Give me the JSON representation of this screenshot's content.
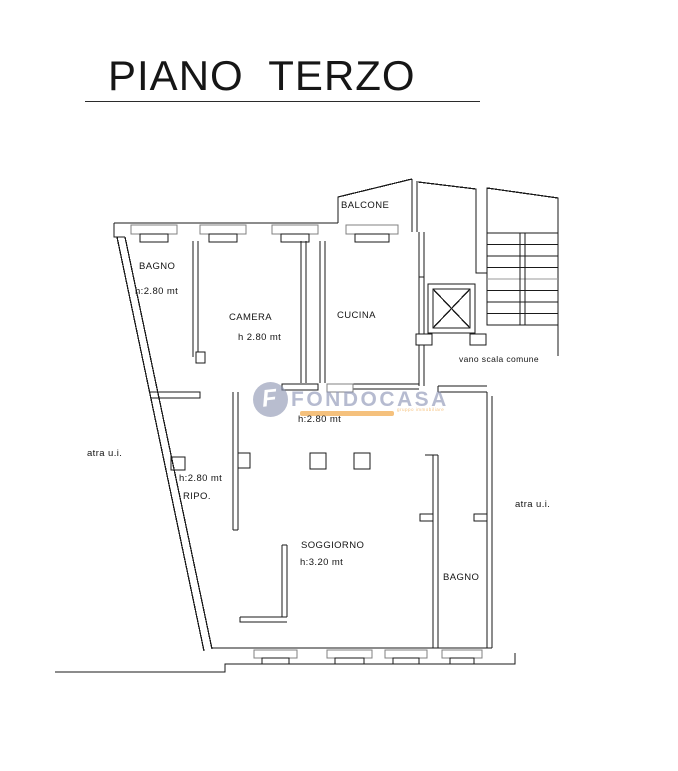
{
  "title": {
    "text": "PIANO  TERZO"
  },
  "plan": {
    "labels": {
      "bagno_nw": "BAGNO",
      "bagno_nw_h": "h:2.80 mt",
      "camera": "CAMERA",
      "camera_h": "h 2.80 mt",
      "cucina": "CUCINA",
      "balcone": "BALCONE",
      "vano_scala": "vano scala comune",
      "hall_h": "h:2.80 mt",
      "atra_ui_left": "atra u.i.",
      "ripo_h": "h:2.80 mt",
      "ripo": "RIPO.",
      "soggiorno": "SOGGIORNO",
      "soggiorno_h": "h:3.20 mt",
      "bagno_se": "BAGNO",
      "atra_ui_right": "atra u.i."
    },
    "line_color": "#1a1a1a",
    "window_color": "#808080"
  },
  "watermark": {
    "brand": "FONDOCASA",
    "icon_letter": "F",
    "tagline": "gruppo immobiliare",
    "brand_color": "#8b93b4",
    "accent_color": "#f09c2e"
  }
}
